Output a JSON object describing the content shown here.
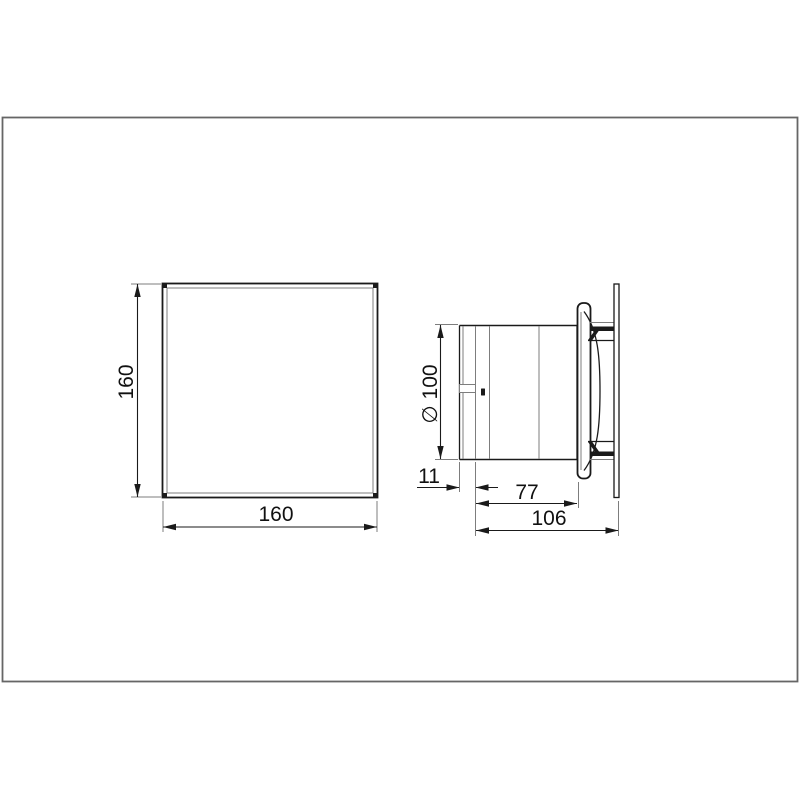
{
  "page": {
    "background_color": "#ffffff",
    "frame_color": "#666666",
    "outline_color": "#1a1a1a",
    "thin_line_color": "#7d7d7d",
    "text_color": "#111111"
  },
  "drawing": {
    "type": "technical-dimension-drawing",
    "subject": "extractor-fan",
    "front_view": {
      "name": "front-view-square-panel",
      "height_label": "160",
      "width_label": "160"
    },
    "side_view": {
      "name": "side-view-profile",
      "diameter_label": "∅ 100",
      "spigot_label": "11",
      "body_depth_label": "77",
      "total_depth_label": "106"
    }
  }
}
